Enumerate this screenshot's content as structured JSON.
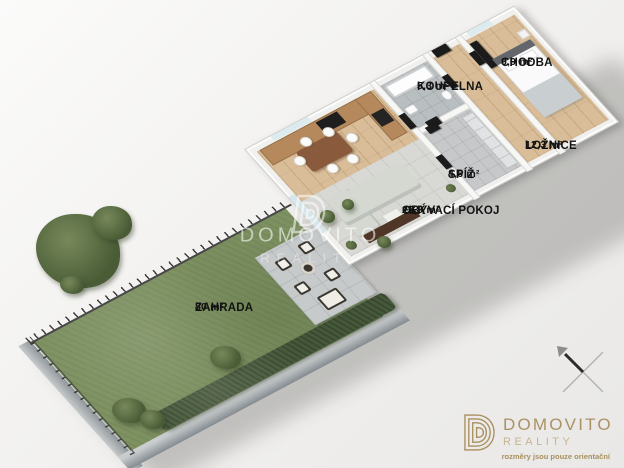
{
  "rooms": [
    {
      "name": "KOUPELNA",
      "area": "5,3 m²"
    },
    {
      "name": "CHODBA",
      "area": "9,9 m²"
    },
    {
      "name": "LOŽNICE",
      "area": "12,3 m²"
    },
    {
      "name": "SPÍŽ",
      "area": "4,6 m²"
    },
    {
      "name": "OBÝVACÍ POKOJ",
      "suffix": "+KK",
      "area": "25,9 m²"
    },
    {
      "name": "ZAHRADA",
      "area": "80 m²"
    }
  ],
  "watermark": {
    "brand": "DOMOVITO",
    "sub": "REALITY"
  },
  "logo": {
    "brand": "DOMOVITO",
    "sub": "REALITY",
    "tagline": "rozměry jsou pouze orientační"
  },
  "icons": {
    "watermark_mark": "domovito-d-icon",
    "logo_mark": "domovito-d-icon",
    "compass": "compass-cross-icon"
  },
  "colors": {
    "logo_gold": "#ab9265",
    "logo_gold_light": "#c6b493",
    "garden_green": "#7d9161",
    "hedge_green": "#46583a",
    "wood_floor": "#d9bd98",
    "tile_gray": "#d8d8d4",
    "door_black": "#1b1b1b",
    "label_text": "#131313",
    "background": "#f0efed"
  }
}
